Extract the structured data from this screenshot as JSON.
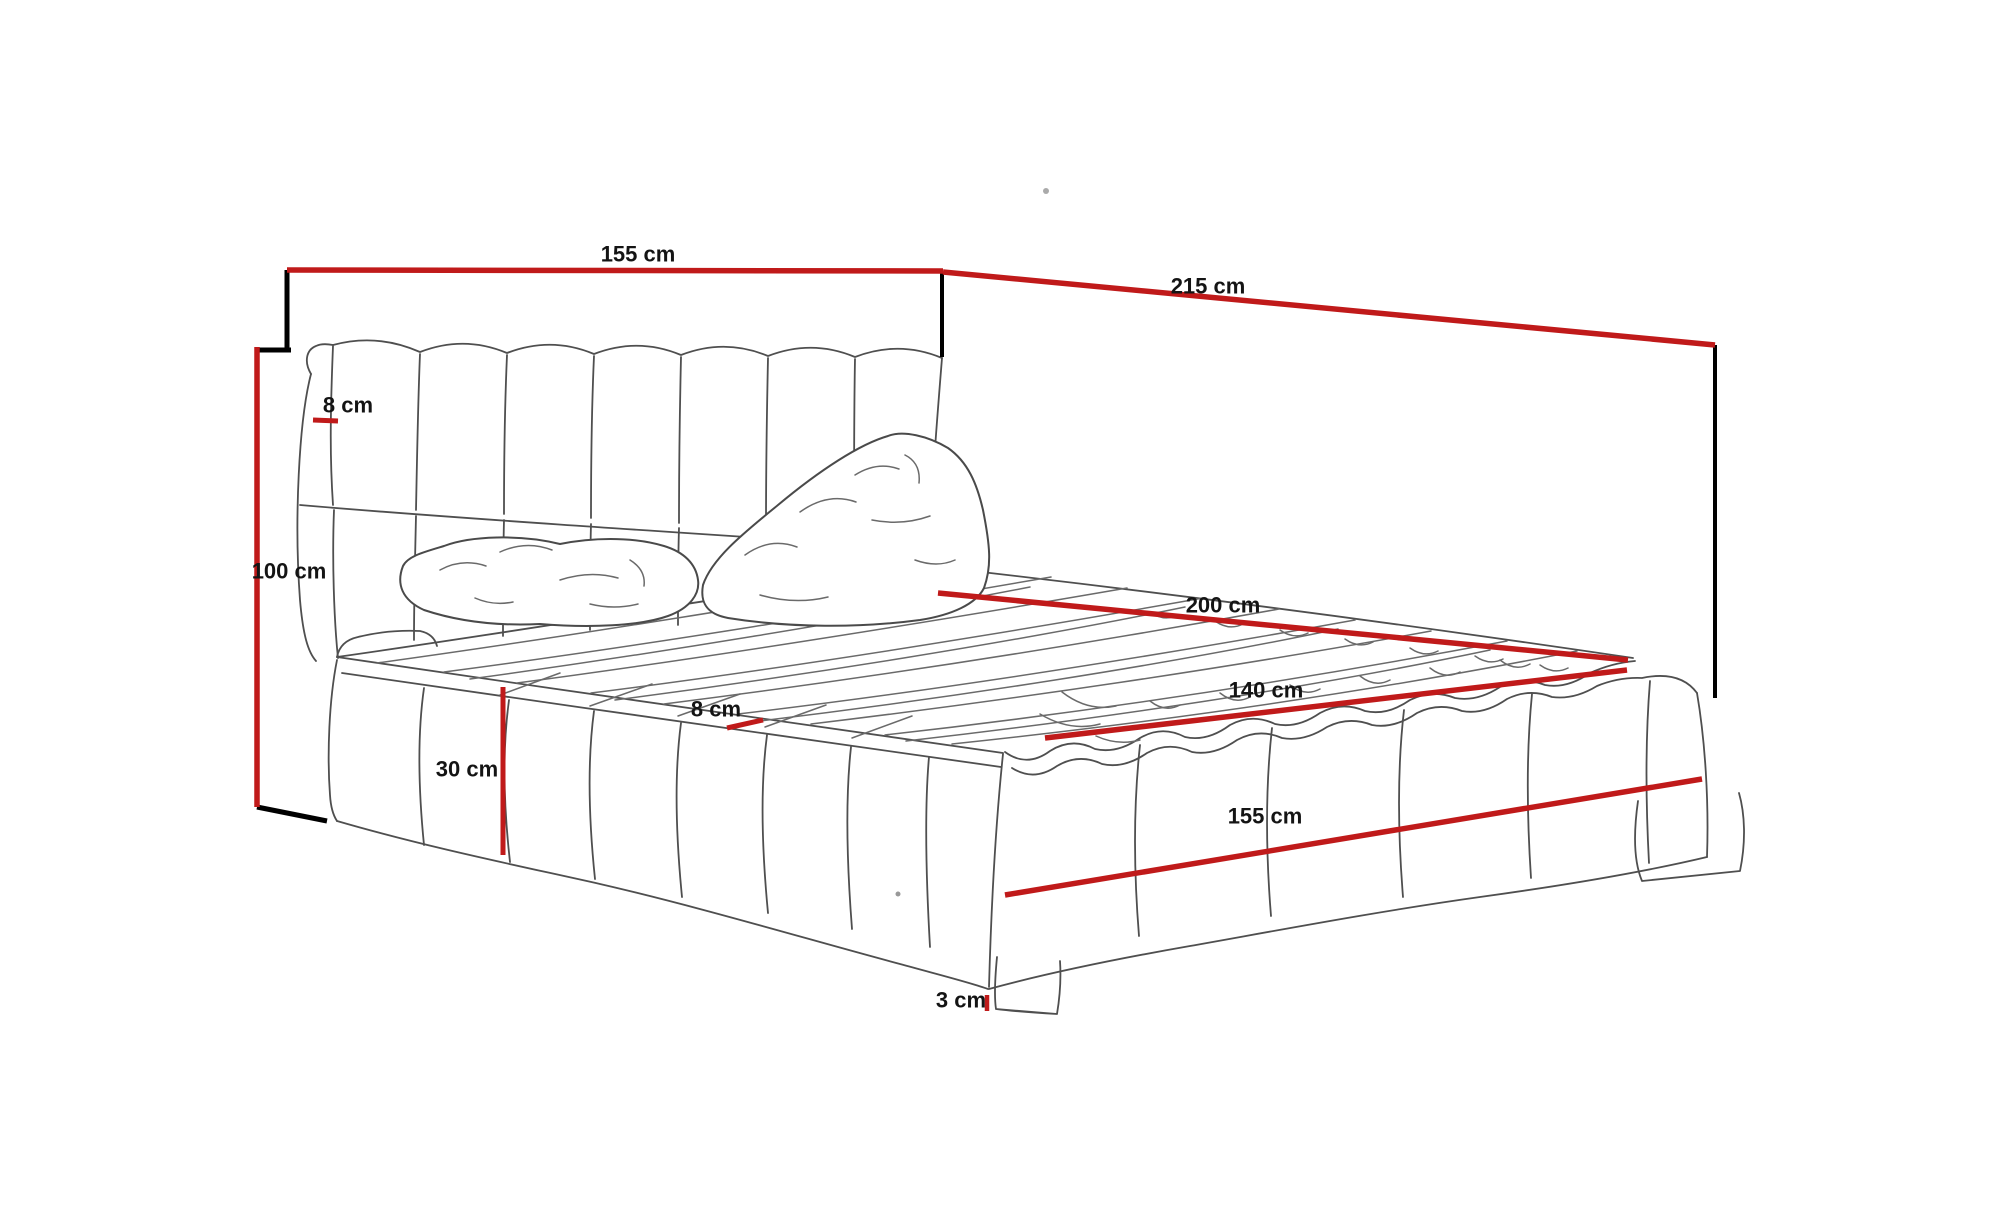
{
  "diagram": {
    "subject": "upholstered-bed-dimension-sketch",
    "unit": "cm"
  },
  "colors": {
    "dimension_line": "#c01a1a",
    "construction_line": "#000000",
    "sketch_line": "#4f4f4f",
    "label_text": "#141414",
    "background": "#ffffff"
  },
  "dimensions": [
    {
      "id": "headboard-width",
      "label": "155 cm",
      "label_x": 638,
      "label_y": 254,
      "x1": 287,
      "y1": 270,
      "x2": 943,
      "y2": 271,
      "width": 5.5
    },
    {
      "id": "bed-length",
      "label": "215 cm",
      "label_x": 1208,
      "label_y": 286,
      "x1": 943,
      "y1": 272,
      "x2": 1715,
      "y2": 345,
      "width": 5.5
    },
    {
      "id": "headboard-height",
      "label": "100 cm",
      "label_x": 289,
      "label_y": 571,
      "x1": 257,
      "y1": 347,
      "x2": 257,
      "y2": 807,
      "width": 5.5
    },
    {
      "id": "headboard-thickness",
      "label": "8 cm",
      "label_x": 348,
      "label_y": 405,
      "x1": 313,
      "y1": 420,
      "x2": 338,
      "y2": 421,
      "width": 5
    },
    {
      "id": "base-height",
      "label": "30 cm",
      "label_x": 467,
      "label_y": 769,
      "x1": 503,
      "y1": 687,
      "x2": 503,
      "y2": 855,
      "width": 5
    },
    {
      "id": "frame-rail-thickness",
      "label": "8 cm",
      "label_x": 716,
      "label_y": 709,
      "x1": 727,
      "y1": 728,
      "x2": 763,
      "y2": 720,
      "width": 5
    },
    {
      "id": "mattress-length",
      "label": "200 cm",
      "label_x": 1223,
      "label_y": 605,
      "x1": 938,
      "y1": 593,
      "x2": 1628,
      "y2": 660,
      "width": 5.5
    },
    {
      "id": "mattress-width",
      "label": "140 cm",
      "label_x": 1266,
      "label_y": 690,
      "x1": 1045,
      "y1": 738,
      "x2": 1627,
      "y2": 670,
      "width": 5.5
    },
    {
      "id": "base-width",
      "label": "155 cm",
      "label_x": 1265,
      "label_y": 816,
      "x1": 1005,
      "y1": 895,
      "x2": 1702,
      "y2": 779,
      "width": 5.5
    },
    {
      "id": "leg-height",
      "label": "3 cm",
      "label_x": 961,
      "label_y": 1000,
      "x1": 987,
      "y1": 995,
      "x2": 987,
      "y2": 1011,
      "width": 4.5
    }
  ],
  "construction_lines": [
    {
      "id": "tick-top-left",
      "x1": 287,
      "y1": 270,
      "x2": 287,
      "y2": 350,
      "width": 5
    },
    {
      "id": "tick-top-right",
      "x1": 942,
      "y1": 272,
      "x2": 942,
      "y2": 357,
      "width": 4
    },
    {
      "id": "tick-far-right",
      "x1": 1715,
      "y1": 345,
      "x2": 1715,
      "y2": 698,
      "width": 4
    },
    {
      "id": "tick-height-top",
      "x1": 257,
      "y1": 350,
      "x2": 291,
      "y2": 350,
      "width": 5
    },
    {
      "id": "tick-height-bottom",
      "x1": 257,
      "y1": 807,
      "x2": 327,
      "y2": 821,
      "width": 5
    }
  ]
}
